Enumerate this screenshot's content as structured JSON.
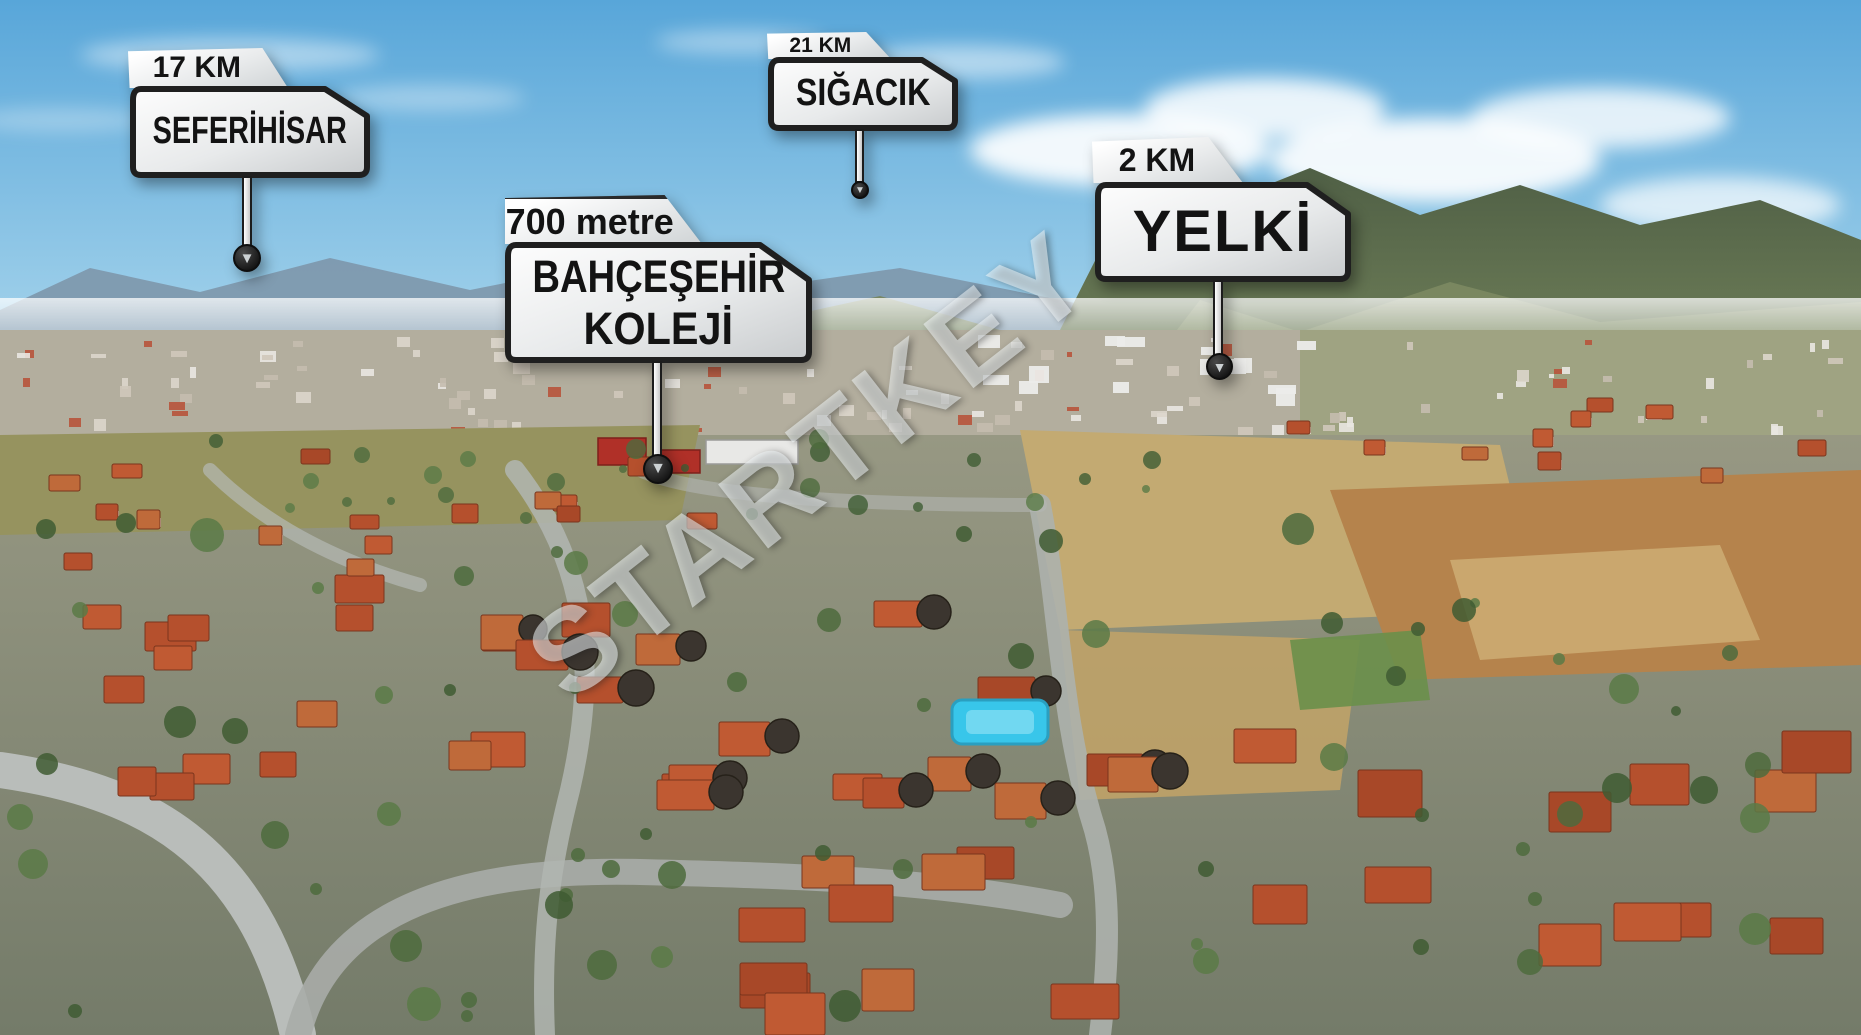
{
  "watermark": {
    "text": "STARTKEY"
  },
  "icons": {
    "arrow_down": "▼"
  },
  "signs": [
    {
      "id": "seferihisar",
      "distance": "17 KM",
      "name": "SEFERİHİSAR"
    },
    {
      "id": "sigacik",
      "distance": "21 KM",
      "name": "SIĞACIK"
    },
    {
      "id": "bahcesehir-koleji",
      "distance": "700 metre",
      "name": "BAHÇEŞEHİR",
      "name_line2": "KOLEJİ"
    },
    {
      "id": "yelki",
      "distance": "2 KM",
      "name": "YELKİ"
    }
  ],
  "colors": {
    "sign_plate": "#f1f2f3",
    "sign_border": "#1f1f1f",
    "sign_text": "#131313",
    "roof_orange": "#b5502d",
    "sky_blue": "#5aa7d8",
    "pool_cyan": "#38c6ea"
  }
}
